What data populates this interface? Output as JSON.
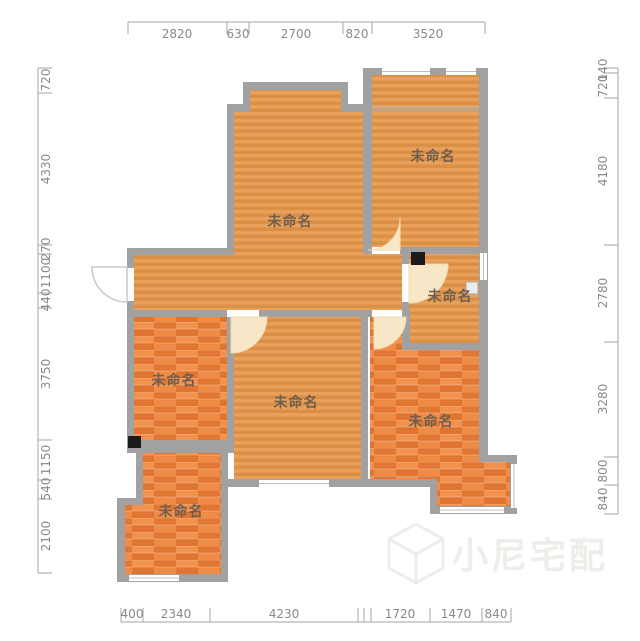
{
  "title": "floor-plan",
  "rooms": [
    {
      "label": "未命名"
    },
    {
      "label": "未命名"
    },
    {
      "label": "未命名"
    },
    {
      "label": "未命名"
    },
    {
      "label": "未命名"
    },
    {
      "label": "未命名"
    },
    {
      "label": "未命名"
    }
  ],
  "dims": {
    "top": [
      "2820",
      "630",
      "2700",
      "820",
      "3520"
    ],
    "bottom": [
      "400",
      "2340",
      "4230",
      "1720",
      "1470",
      "840"
    ],
    "left": [
      "720",
      "4330",
      "270",
      "1100",
      "440",
      "3750",
      "1150",
      "540",
      "2100"
    ],
    "right": [
      "140",
      "720",
      "4180",
      "2780",
      "3280",
      "800",
      "840"
    ]
  },
  "watermark": {
    "text": "小尼宅配",
    "logo": "cube-logo-icon"
  },
  "colors": {
    "wall": "#a1a1a1",
    "floor_light": "#e29750",
    "floor_dark": "#e8813c",
    "door_arc": "#f7e7c6",
    "dimension_text": "#8a8a8a",
    "flue_marker": "#1b1b1b"
  }
}
